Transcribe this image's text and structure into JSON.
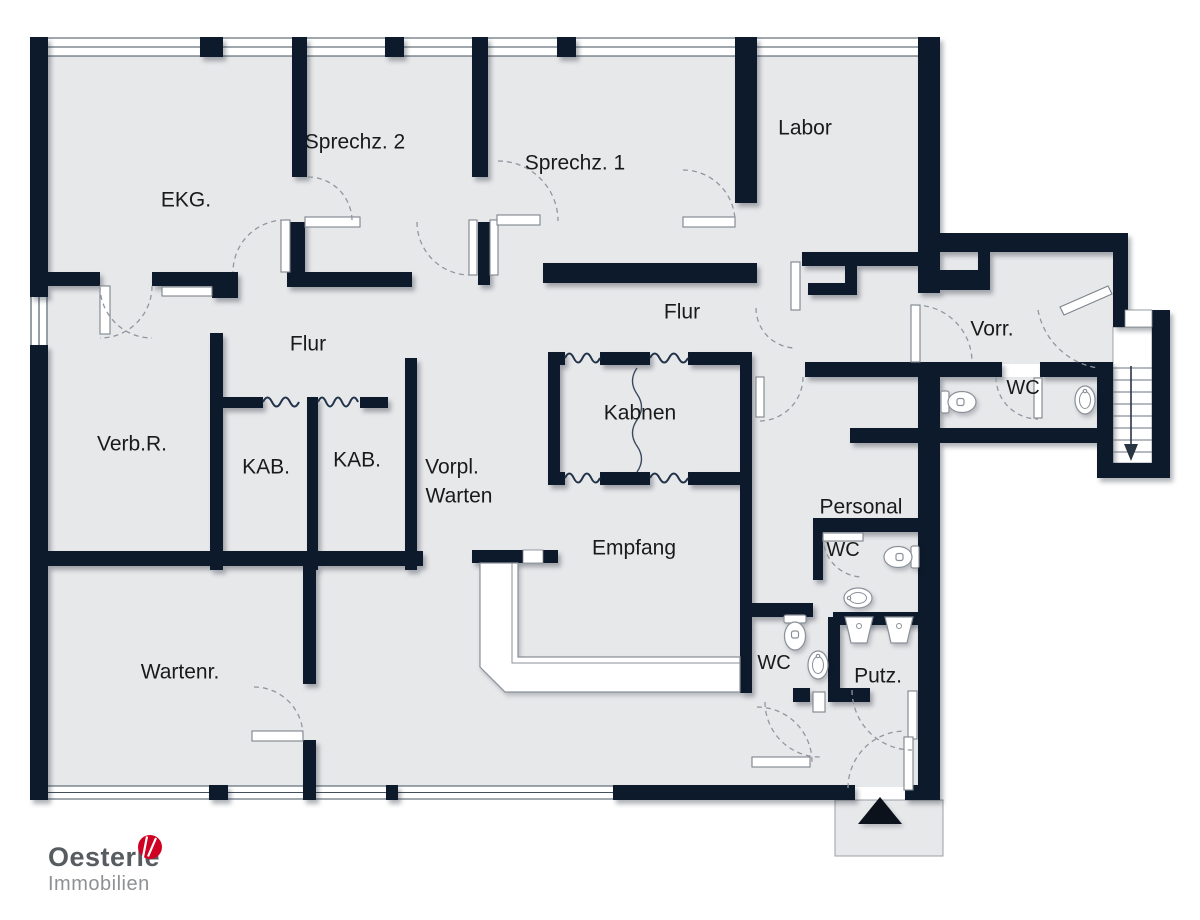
{
  "plan": {
    "type": "real-estate floor plan",
    "labels": {
      "ekg": "EKG.",
      "sprechz2": "Sprechz. 2",
      "sprechz1": "Sprechz. 1",
      "labor": "Labor",
      "flur_west": "Flur",
      "flur_east": "Flur",
      "verbr": "Verb.R.",
      "kab1": "KAB.",
      "kab2": "KAB.",
      "vorpl_line1": "Vorpl.",
      "vorpl_line2": "Warten",
      "kabnen": "Kabnen",
      "empfang": "Empfang",
      "wartenr": "Wartenr.",
      "personal": "Personal",
      "wc_personal": "WC",
      "wc_bottom": "WC",
      "putz": "Putz.",
      "vorr": "Vorr.",
      "wc_right": "WC"
    },
    "icons": {
      "entrance_arrow": "entrance-arrow",
      "staircase": "staircase-down",
      "toilet": "toilet-icon",
      "sink": "sink-icon",
      "basin": "utility-basin-icon",
      "curtain": "curtain-wave",
      "counter": "reception-counter"
    },
    "colors": {
      "wall": "#0c1a2b",
      "floor": "#e7e8ea",
      "arc": "#9097a0",
      "label": "#1a1a1a",
      "logo_red": "#cf0021",
      "logo_gray": "#575c60",
      "logo_light_gray": "#8d9194"
    }
  },
  "logo": {
    "name": "Oesterle",
    "subtitle": "Immobilien"
  }
}
